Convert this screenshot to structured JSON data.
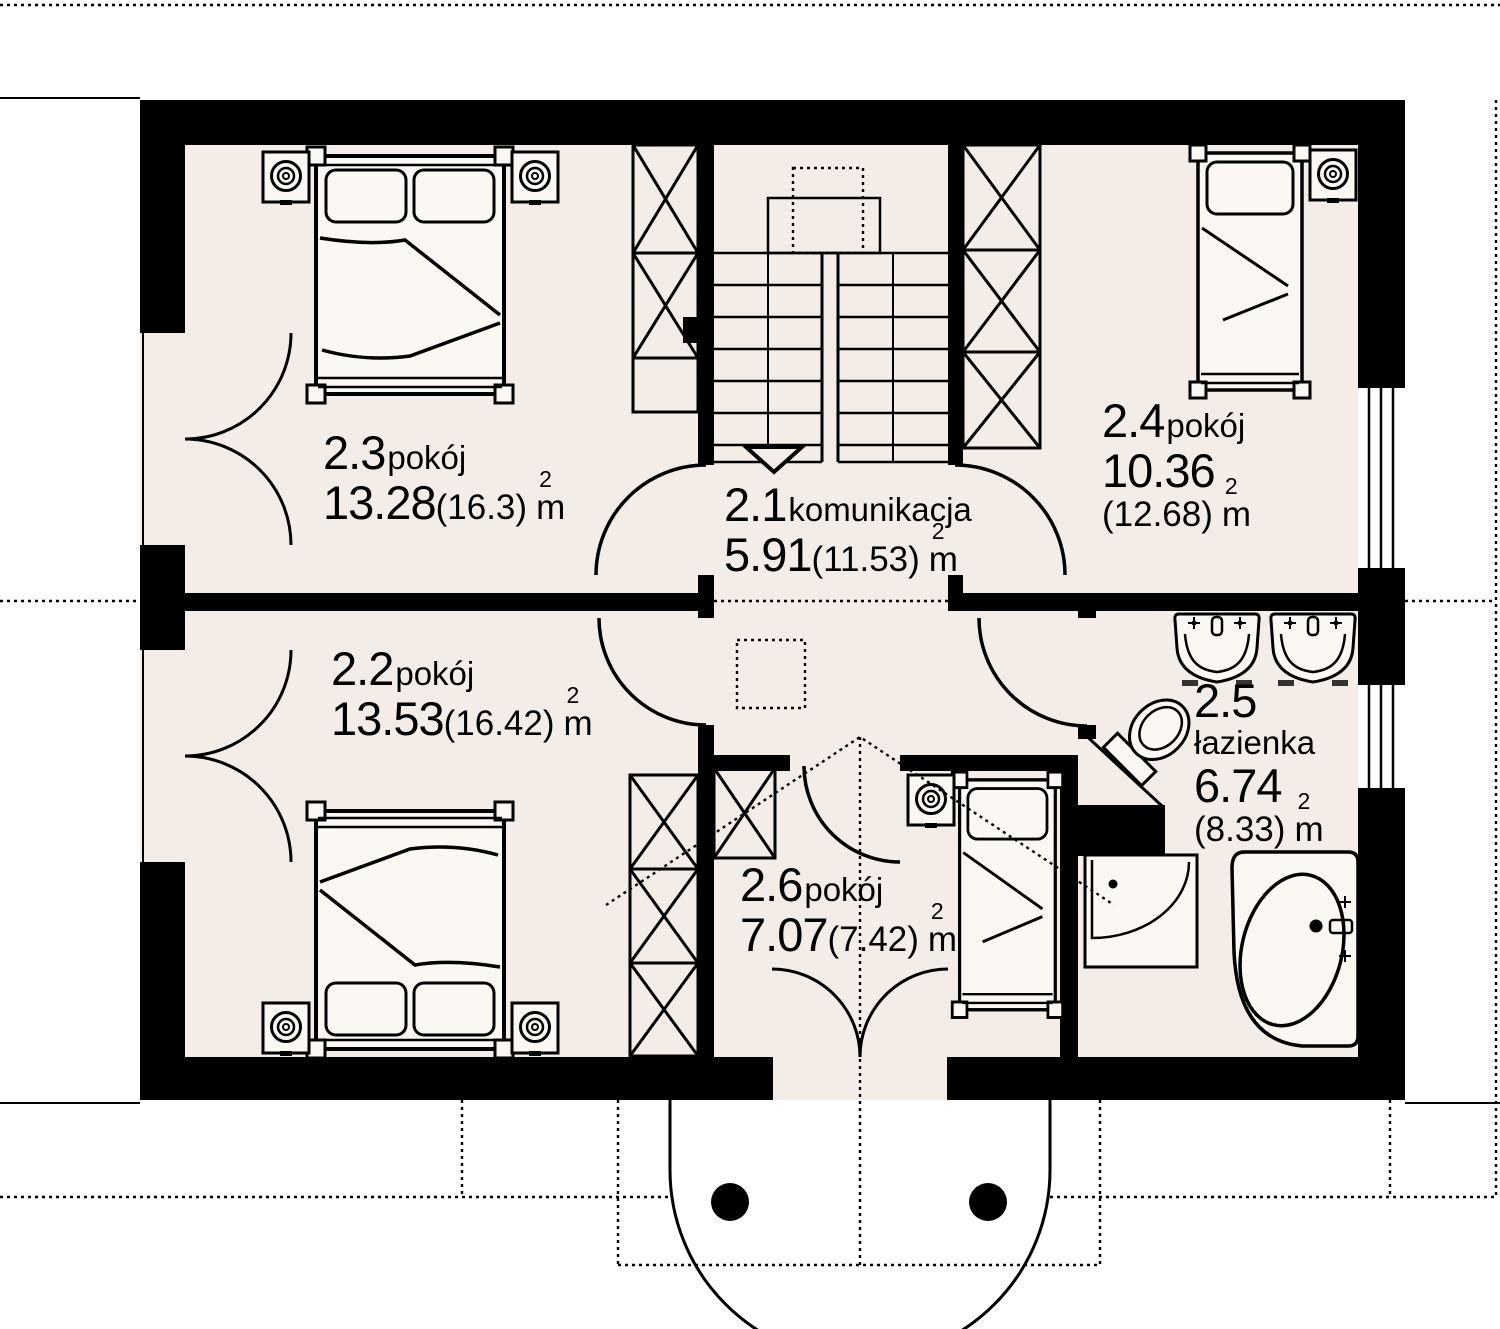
{
  "plan": {
    "title": "floor-plan-upper-storey",
    "unit": {
      "base": "m",
      "sup": "2"
    },
    "colors": {
      "floor": "#f4ece6",
      "wall": "#000000",
      "paper": "#ffffff"
    },
    "rooms": [
      {
        "id": "2.1",
        "name": "komunikacja",
        "area": "5.91",
        "gross": "(11.53)"
      },
      {
        "id": "2.2",
        "name": "pokój",
        "area": "13.53",
        "gross": "(16.42)"
      },
      {
        "id": "2.3",
        "name": "pokój",
        "area": "13.28",
        "gross": "(16.3)"
      },
      {
        "id": "2.4",
        "name": "pokój",
        "area": "10.36",
        "gross": "(12.68)"
      },
      {
        "id": "2.5",
        "name": "łazienka",
        "area": "6.74",
        "gross": "(8.33)"
      },
      {
        "id": "2.6",
        "name": "pokój",
        "area": "7.07",
        "gross": "(7.42)"
      }
    ]
  }
}
